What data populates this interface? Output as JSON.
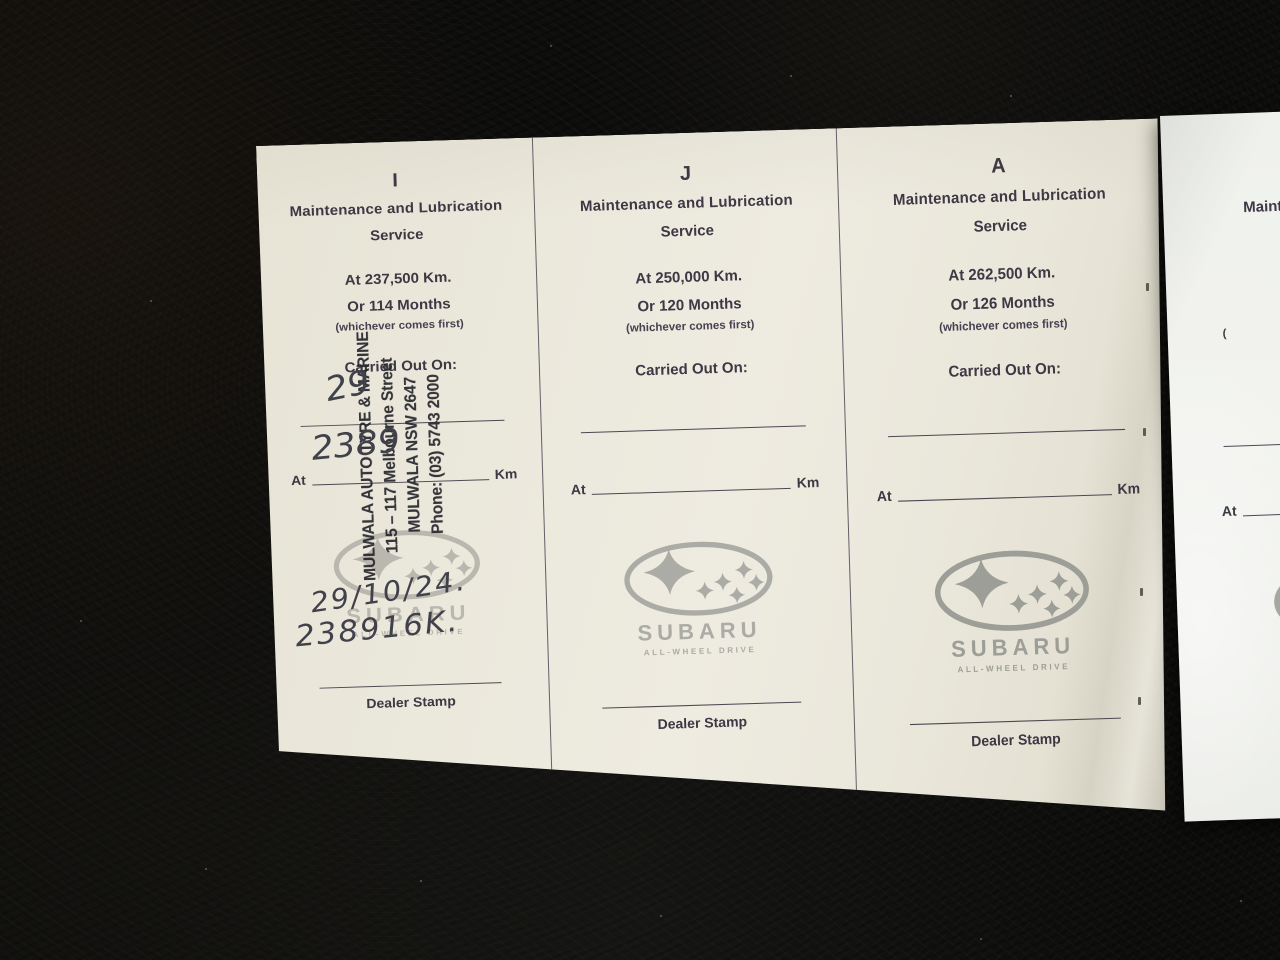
{
  "colors": {
    "paper_cream": "#e9e6da",
    "paper_white": "#f0f2ee",
    "print_ink": "#3e3744",
    "logo_gray": "#a3a49e",
    "stamp_ink": "#34343a",
    "pen_ink": "#41414b",
    "carpet": "#0c0c0b"
  },
  "booklet": {
    "panels": [
      {
        "letter": "I",
        "title": "Maintenance and Lubrication",
        "subtitle": "Service",
        "km_line": "At 237,500 Km.",
        "months_line": "Or 114 Months",
        "note": "(whichever comes first)",
        "carried_label": "Carried Out On:",
        "at_label": "At",
        "km_label": "Km",
        "dealer_label": "Dealer Stamp",
        "logo": {
          "brand": "SUBARU",
          "tagline": "ALL-WHEEL DRIVE"
        },
        "stamp": {
          "lines": [
            "MULWALA AUTO TYRE & MARINE",
            "115 – 117 Melbourne Street",
            "MULWALA NSW 2647",
            "Phone: (03) 5743 2000"
          ]
        },
        "handwriting": {
          "date_on_line": "29",
          "km_on_line": "2389",
          "date_below_logo": "29/10/24.",
          "km_below_logo": "238916K."
        }
      },
      {
        "letter": "J",
        "title": "Maintenance and Lubrication",
        "subtitle": "Service",
        "km_line": "At 250,000 Km.",
        "months_line": "Or 120 Months",
        "note": "(whichever comes first)",
        "carried_label": "Carried Out On:",
        "at_label": "At",
        "km_label": "Km",
        "dealer_label": "Dealer Stamp",
        "logo": {
          "brand": "SUBARU",
          "tagline": "ALL-WHEEL DRIVE"
        }
      },
      {
        "letter": "A",
        "title": "Maintenance and Lubrication",
        "subtitle": "Service",
        "km_line": "At 262,500 Km.",
        "months_line": "Or 126 Months",
        "note": "(whichever comes first)",
        "carried_label": "Carried Out On:",
        "at_label": "At",
        "km_label": "Km",
        "dealer_label": "Dealer Stamp",
        "logo": {
          "brand": "SUBARU",
          "tagline": "ALL-WHEEL DRIVE"
        }
      }
    ],
    "partial_panel": {
      "title_fragment": "Maint",
      "note_fragment": "(",
      "at_label": "At",
      "logo_brand_fragment": "S",
      "logo_tagline_fragment": "AL"
    }
  }
}
